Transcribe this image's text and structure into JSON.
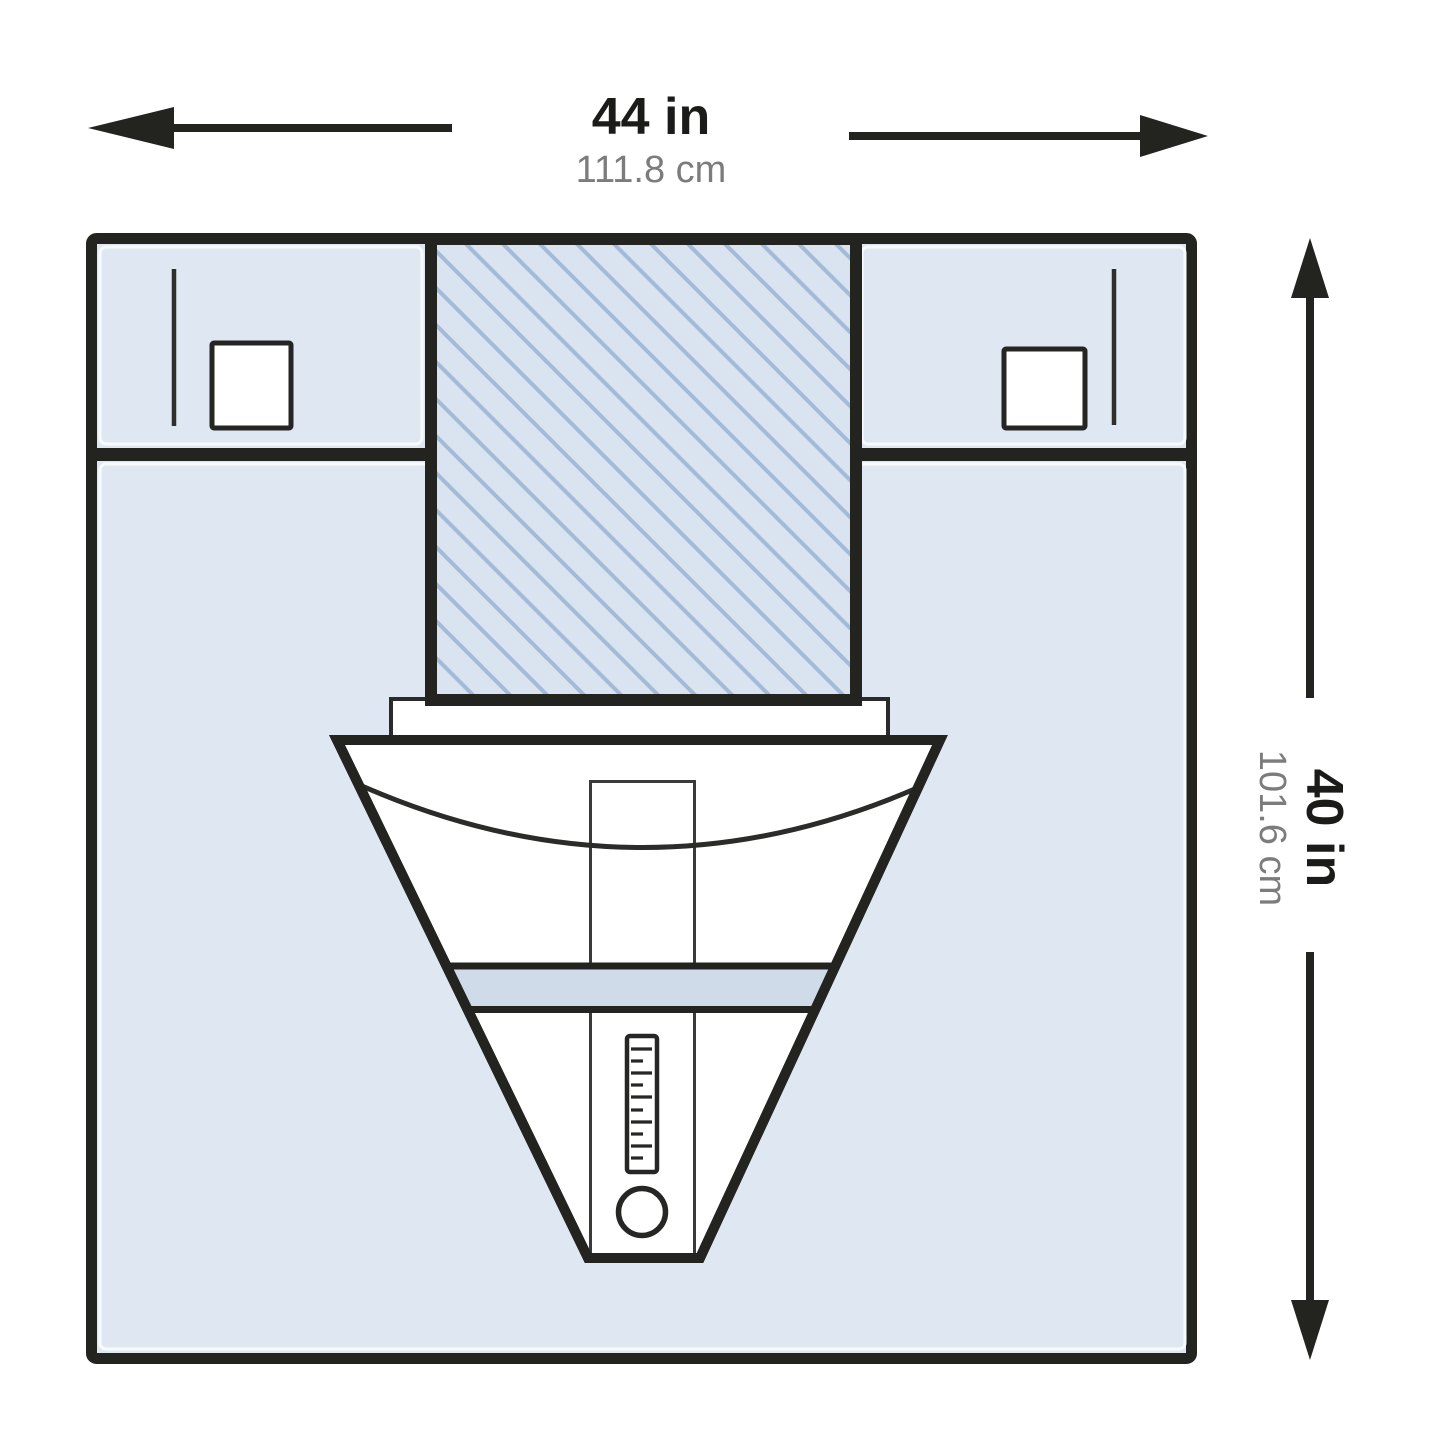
{
  "dimension_labels": {
    "width": {
      "imperial": "44 in",
      "metric": "111.8 cm"
    },
    "height": {
      "imperial": "40 in",
      "metric": "101.6 cm"
    }
  },
  "colors": {
    "outline": "#232320",
    "drape_fill": "#dfe8f2",
    "incise_fill": "#d9e4f0",
    "incise_hatch_line": "#a3bbd8",
    "band_fill": "#cfdbe8",
    "pouch_fill": "#ffffff",
    "imperial_text": "#1b1b19",
    "metric_text": "#7c7c7c"
  }
}
